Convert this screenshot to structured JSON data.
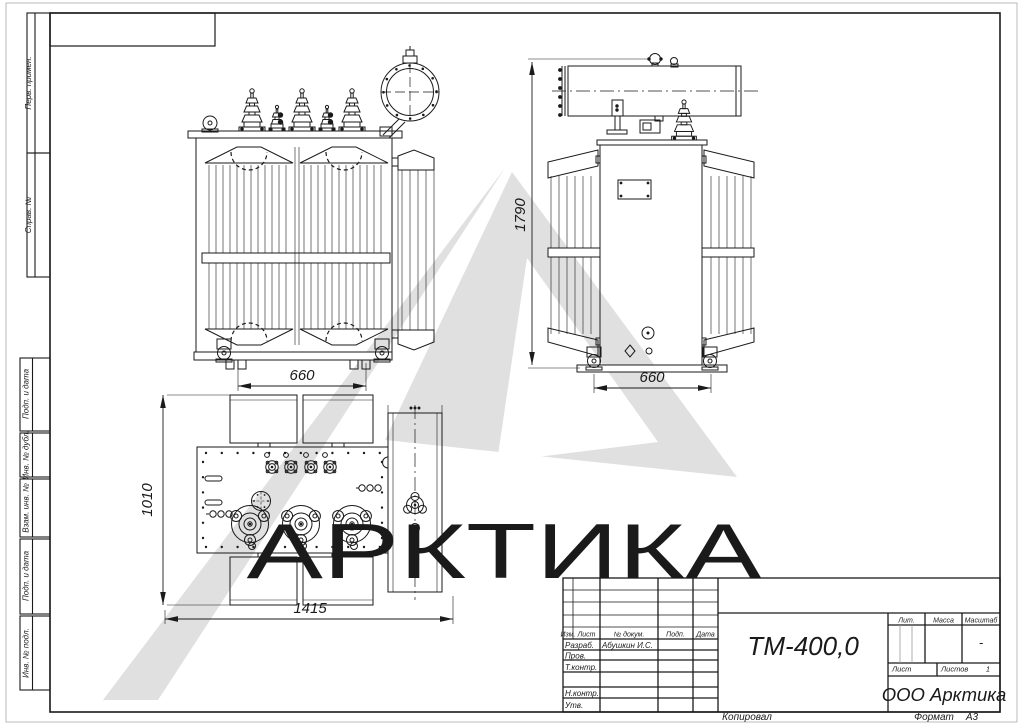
{
  "watermark": {
    "text": "АРКТИКА",
    "color": "#dcdcdc"
  },
  "margin": {
    "labels": [
      "Перв. примен.",
      "Справ. №",
      "Подп. и дата",
      "Инв. № дубл.",
      "Взам. инв. №",
      "Подп. и дата",
      "Инв. № подл."
    ]
  },
  "views": {
    "front": {
      "width_dim": "660"
    },
    "side": {
      "height_dim": "1790",
      "width_dim": "660"
    },
    "plan": {
      "height_dim": "1010",
      "length_dim": "1415"
    }
  },
  "title_block": {
    "revision_header": [
      "Изм.",
      "Лист",
      "№ докум.",
      "Подп.",
      "Дата"
    ],
    "signature_rows": [
      {
        "label": "Разраб.",
        "name": "Абушкин И.С."
      },
      {
        "label": "Пров.",
        "name": ""
      },
      {
        "label": "Т.контр.",
        "name": ""
      },
      {
        "label": "Н.контр.",
        "name": ""
      },
      {
        "label": "Утв.",
        "name": ""
      }
    ],
    "designation": "ТМ-400,0",
    "lit_label": "Лит.",
    "mass_label": "Масса",
    "scale_label": "Масштаб",
    "scale_value": "-",
    "sheet_label": "Лист",
    "sheets_label": "Листов",
    "sheets_value": "1",
    "company": "ООО Арктика"
  },
  "footer": {
    "copied_label": "Копировал",
    "format_label": "Формат",
    "format_value": "А3"
  }
}
